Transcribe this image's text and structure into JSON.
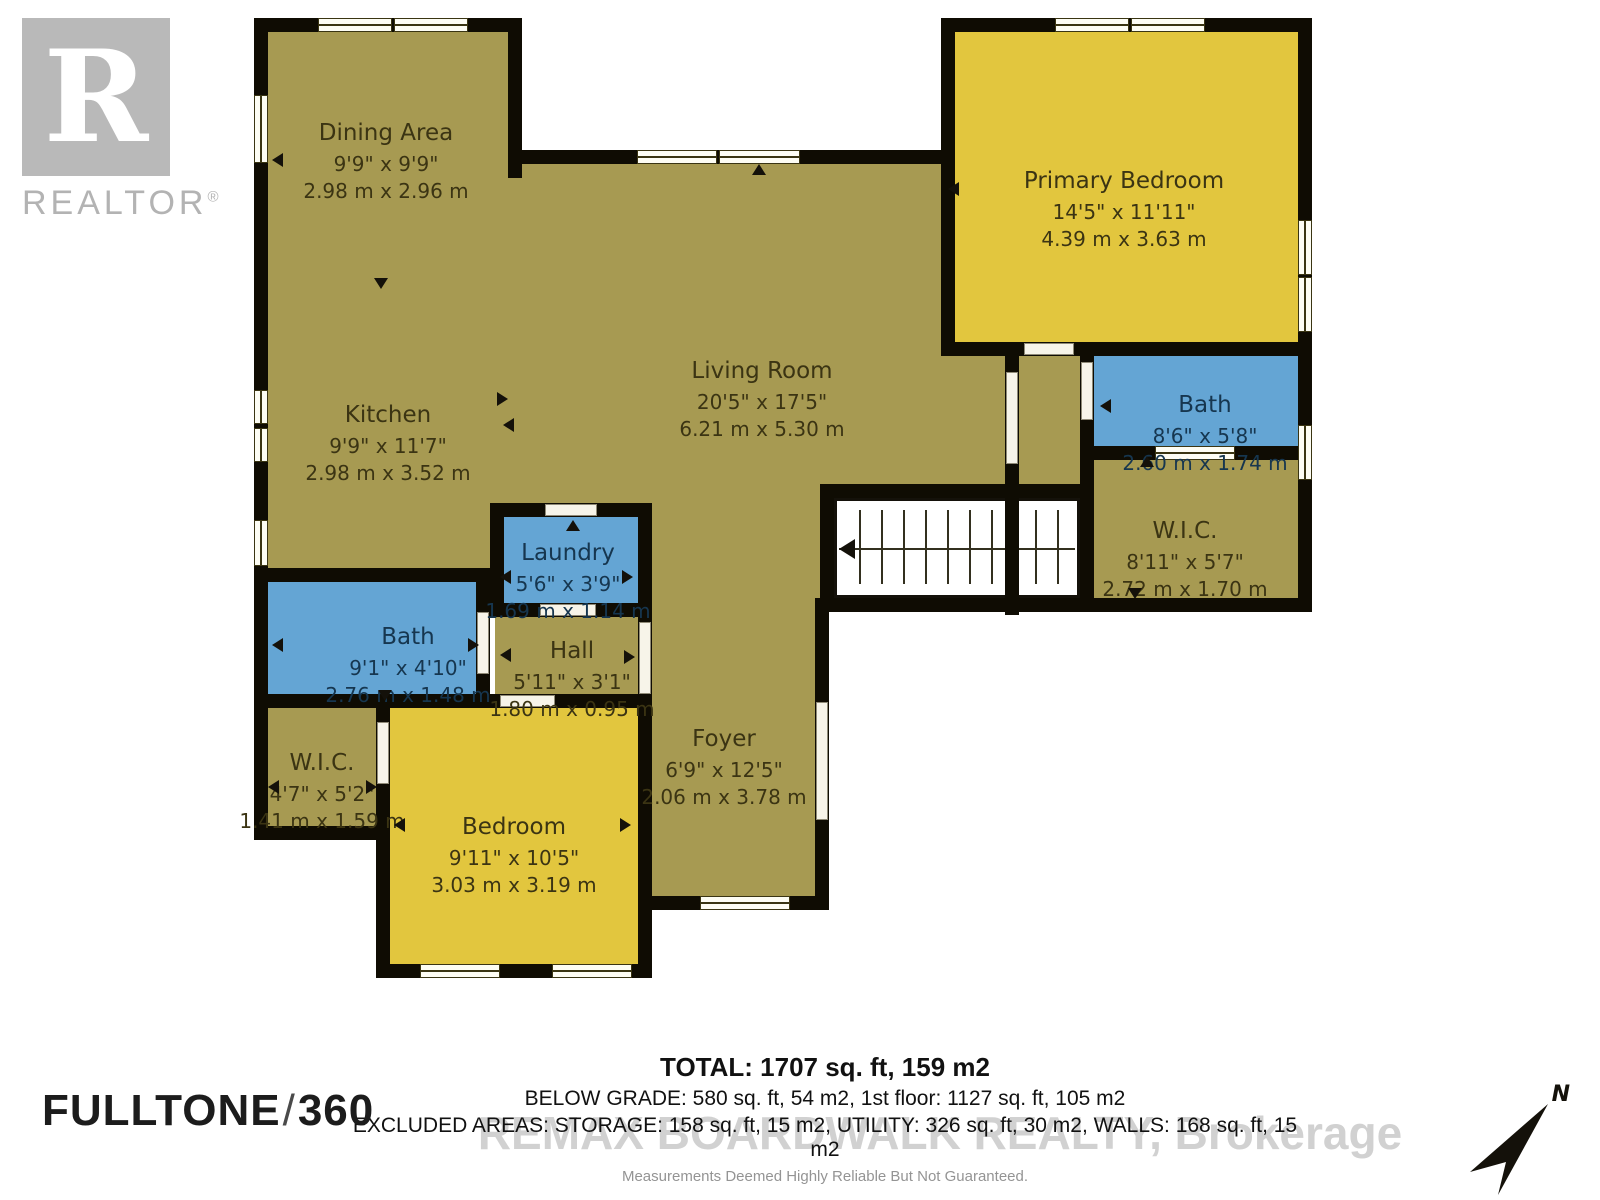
{
  "branding": {
    "realtor_r": "R",
    "realtor_word": "REALTOR",
    "reg_mark": "®",
    "fulltone": {
      "name": "FULLTONE",
      "slash": "/",
      "number": "360"
    },
    "watermark": "REMAX BOARDWALK REALTY, Brokerage"
  },
  "compass": {
    "label": "N"
  },
  "colors": {
    "floor_olive": "#a79a52",
    "room_yellow": "#e2c63e",
    "room_blue": "#64a5d4",
    "wall_black": "#0f0c03",
    "logo_gray": "#b9b9b9"
  },
  "rooms": [
    {
      "name": "Dining Area",
      "imperial": "9'9\" x 9'9\"",
      "metric": "2.98 m x 2.96 m"
    },
    {
      "name": "Kitchen",
      "imperial": "9'9\" x 11'7\"",
      "metric": "2.98 m x 3.52 m"
    },
    {
      "name": "Living Room",
      "imperial": "20'5\" x 17'5\"",
      "metric": "6.21 m x 5.30 m"
    },
    {
      "name": "Primary Bedroom",
      "imperial": "14'5\" x 11'11\"",
      "metric": "4.39 m x 3.63 m"
    },
    {
      "name": "Bath",
      "imperial": "8'6\" x 5'8\"",
      "metric": "2.60 m x 1.74 m"
    },
    {
      "name": "W.I.C.",
      "imperial": "8'11\" x 5'7\"",
      "metric": "2.72 m x 1.70 m"
    },
    {
      "name": "Laundry",
      "imperial": "5'6\" x 3'9\"",
      "metric": "1.69 m x 1.14 m"
    },
    {
      "name": "Hall",
      "imperial": "5'11\" x 3'1\"",
      "metric": "1.80 m x 0.95 m"
    },
    {
      "name": "Bath",
      "imperial": "9'1\" x 4'10\"",
      "metric": "2.76 m x 1.48 m"
    },
    {
      "name": "W.I.C.",
      "imperial": "4'7\" x 5'2\"",
      "metric": "1.41 m x 1.59 m"
    },
    {
      "name": "Bedroom",
      "imperial": "9'11\" x 10'5\"",
      "metric": "3.03 m x 3.19 m"
    },
    {
      "name": "Foyer",
      "imperial": "6'9\" x 12'5\"",
      "metric": "2.06 m x 3.78 m"
    }
  ],
  "summary": {
    "total": "TOTAL: 1707 sq. ft, 159 m2",
    "below_grade": "BELOW GRADE: 580 sq. ft, 54 m2, 1st floor: 1127 sq. ft, 105 m2",
    "excluded": "EXCLUDED AREAS: STORAGE: 158 sq. ft, 15 m2, UTILITY: 326 sq. ft, 30 m2, WALLS: 168 sq. ft, 15 m2",
    "disclaimer": "Measurements Deemed Highly Reliable But Not Guaranteed."
  }
}
